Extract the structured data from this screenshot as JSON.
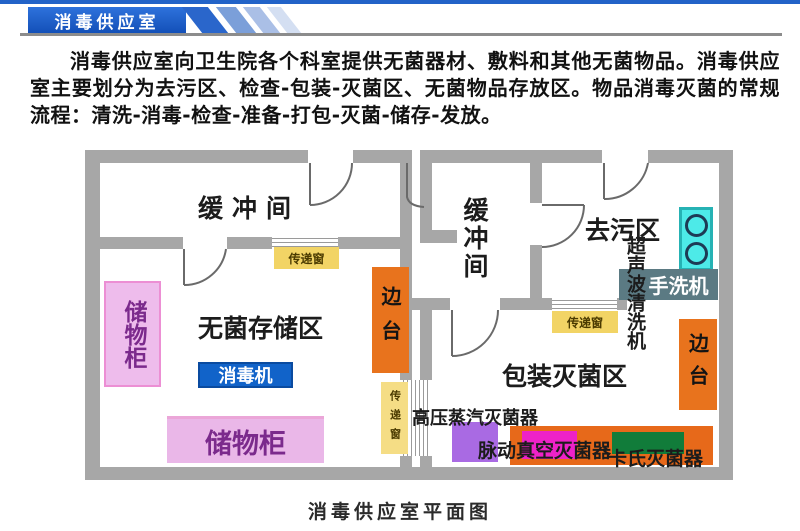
{
  "header": {
    "banner_title": "消毒供应室"
  },
  "intro": {
    "paragraph": "消毒供应室向卫生院各个科室提供无菌器材、敷料和其他无菌物品。消毒供应室主要划分为去污区、检查-包装-灭菌区、无菌物品存放区。物品消毒灭菌的常规流程：清洗-消毒-检查-准备-打包-灭菌-储存-发放。"
  },
  "plan": {
    "caption": "消毒供应室平面图",
    "rooms": {
      "buffer_left": "缓冲间",
      "buffer_middle": "缓冲间",
      "decontamination": "去污区",
      "sterile_storage": "无菌存储区",
      "packing_sterilization": "包装灭菌区"
    },
    "equipment": {
      "storage_cabinet": "储物柜",
      "disinfector": "消毒机",
      "side_table": "边台",
      "pass_window": "传递窗",
      "ultrasonic_cleaner": "超声波清洗机",
      "hand_washer": "手洗机",
      "high_pressure_sterilizer": "高压蒸汽灭菌器",
      "pulse_vacuum_sterilizer": "脉动真空灭菌器",
      "cassette_sterilizer": "卡氏灭菌器"
    },
    "colors": {
      "wall_gray": "#a7a7a7",
      "banner_blue": "#1857c2",
      "pass_window_yellow": "#f2d465",
      "side_table_orange": "#e8731d",
      "cabinet_pink": "#eab7e8",
      "disinfector_blue": "#1163c9",
      "ultrasonic_cyan": "#4deae8",
      "hand_washer_slate": "#5b7a83",
      "sterilizer_purple": "#a96ae3",
      "sterilizer_magenta": "#ee22c8",
      "sterilizer_green": "#117c3a"
    }
  }
}
